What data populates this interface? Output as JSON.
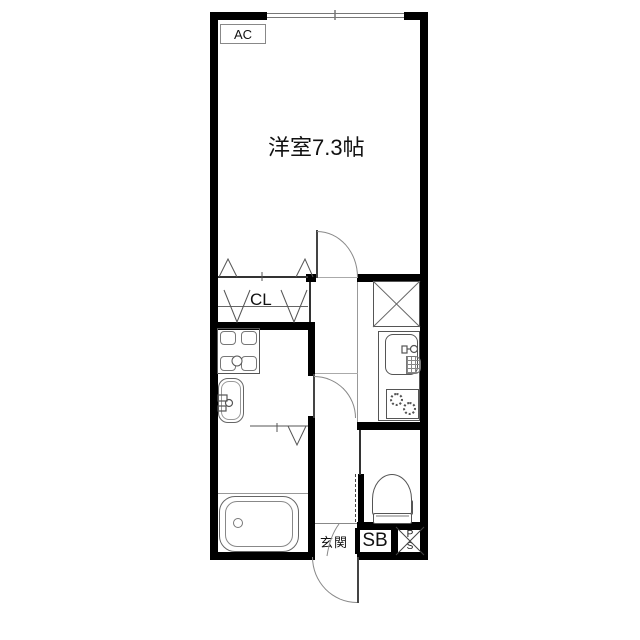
{
  "floorplan": {
    "labels": {
      "ac": "AC",
      "room": "洋室7.3帖",
      "closet": "CL",
      "entrance": "玄関",
      "shoe_box": "SB",
      "pipe_space_line1": "P",
      "pipe_space_line2": "S"
    },
    "colors": {
      "wall": "#000000",
      "thin_line": "#777777",
      "background": "#ffffff",
      "text": "#111111"
    },
    "fixtures": [
      "window",
      "closet-folding-doors",
      "hinged-door-room",
      "hinged-door-washroom",
      "entrance-door",
      "washing-machine-pan",
      "washbasin",
      "kitchen-sink",
      "gas-stove",
      "cross-box",
      "toilet",
      "bathtub",
      "shoe-box",
      "pipe-space"
    ]
  }
}
